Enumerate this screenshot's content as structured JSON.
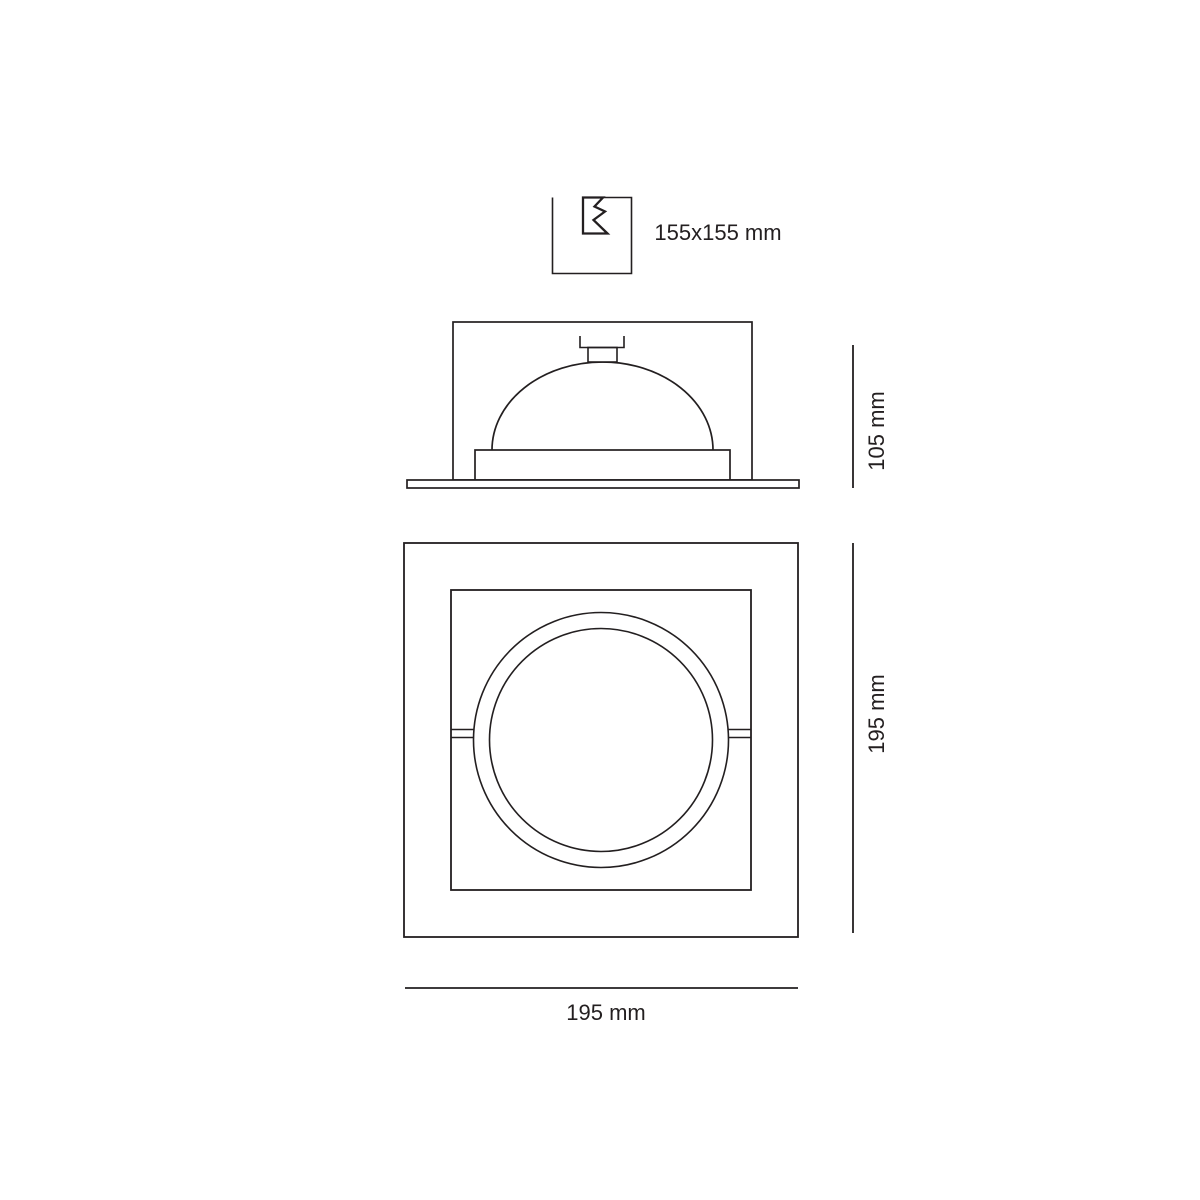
{
  "colors": {
    "line": "#231f20",
    "bg": "#ffffff"
  },
  "drawing": {
    "cutout": {
      "icon": "ceiling-cutout-icon",
      "label": "155x155 mm"
    },
    "side_view": {
      "depth_label": "105 mm"
    },
    "front_view": {
      "height_label": "195 mm",
      "width_label": "195 mm"
    }
  }
}
